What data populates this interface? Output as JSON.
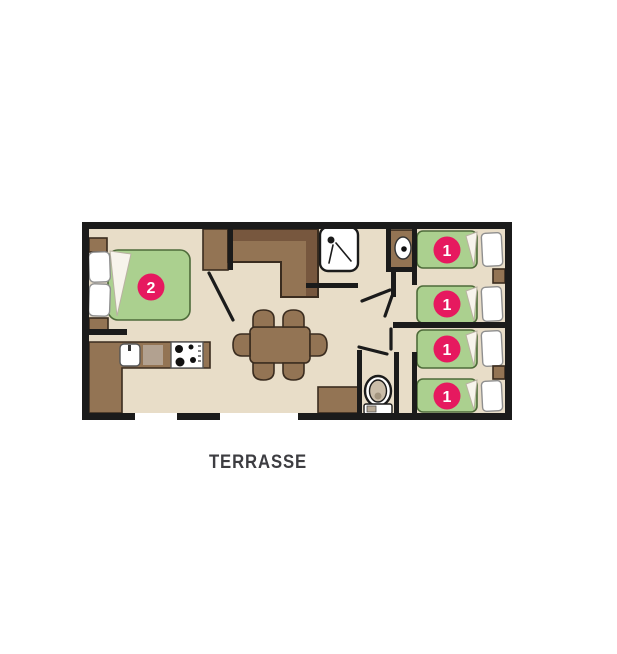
{
  "plan": {
    "terrace_label": "TERRASSE",
    "markers": [
      {
        "id": "double-bed",
        "label": "2"
      },
      {
        "id": "single-bed-1",
        "label": "1"
      },
      {
        "id": "single-bed-2",
        "label": "1"
      },
      {
        "id": "single-bed-3",
        "label": "1"
      },
      {
        "id": "single-bed-4",
        "label": "1"
      }
    ]
  },
  "colors": {
    "floor": "#e8ddc8",
    "wall": "#1b1b1b",
    "furniture": "#937454",
    "furniture-dark": "#77573e",
    "furniture-outline": "#3a2c1f",
    "bed-green": "#abd08f",
    "bed-green-outline": "#4e6b3a",
    "marker-pink": "#e6195f",
    "marker-text": "#ffffff",
    "pillow-outline": "#8f8f8f",
    "label-text": "#3d3d41"
  }
}
